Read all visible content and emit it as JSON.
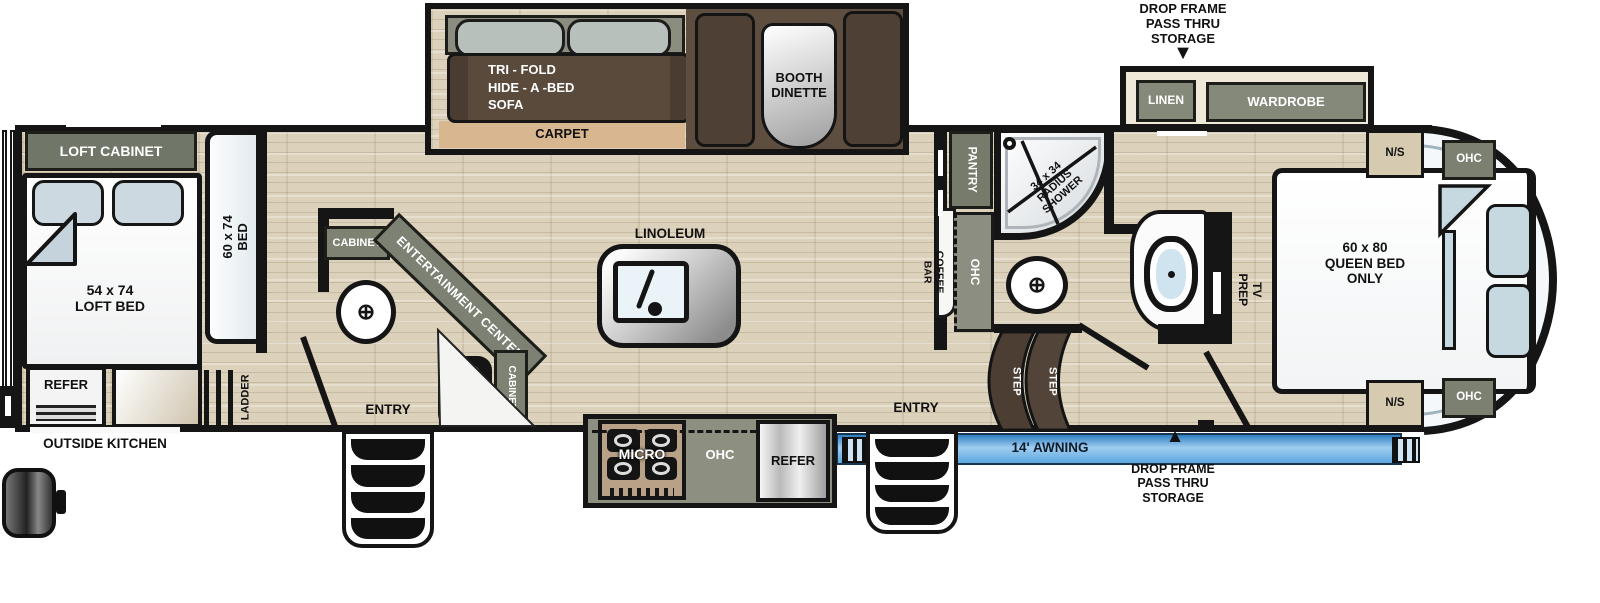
{
  "rear": {
    "loft_cabinet": "LOFT CABINET",
    "loft_bed": "54 x 74\nLOFT BED",
    "bed": "60 x 74\nBED",
    "refer": "REFER",
    "ladder": "LADDER",
    "outside_kitchen": "OUTSIDE KITCHEN"
  },
  "living": {
    "ohc": "OHC",
    "sofa": "TRI - FOLD\nHIDE - A -BED\nSOFA",
    "carpet": "CARPET",
    "booth_dinette": "BOOTH\nDINETTE",
    "cabinet_upper": "CABINET",
    "entertainment_center": "ENTERTAINMENT CENTER",
    "med": "MED",
    "cabinet_lower": "CABINET",
    "entry": "ENTRY",
    "linoleum": "LINOLEUM"
  },
  "kitchen": {
    "micro": "MICRO",
    "ohc": "OHC",
    "refer": "REFER",
    "pantry": "PANTRY",
    "coffee_bar": "COFFEE\nBAR",
    "coffee_ohc": "OHC"
  },
  "bath": {
    "shower": "34 x 34\nRADIUS\nSHOWER",
    "step_1": "STEP",
    "step_2": "STEP",
    "entry": "ENTRY"
  },
  "bedroom": {
    "drop_frame_top": "DROP FRAME\nPASS THRU\nSTORAGE",
    "linen": "LINEN",
    "wardrobe": "WARDROBE",
    "ns_top": "N/S",
    "ohc_top": "OHC",
    "tv_prep": "TV PREP",
    "queen_bed": "60 x 80\nQUEEN BED\nONLY",
    "ns_bottom": "N/S",
    "ohc_bottom": "OHC"
  },
  "exterior": {
    "awning": "14' AWNING",
    "drop_frame_bottom": "DROP FRAME\nPASS THRU\nSTORAGE"
  },
  "icons": {
    "arrow_down": "▼",
    "arrow_up": "▲",
    "toilet_cross": "⊕"
  },
  "colors": {
    "cabinet_olive": "#7e8273",
    "wood_floor": "#dcd1ba",
    "carpet_tan": "#d8b68f",
    "sofa_brown": "#5a4a3c",
    "step_brown": "#4c3e33",
    "awning_blue": "#5ea7e0",
    "pillow_blue": "#c6d8e0",
    "wall_black": "#151515"
  }
}
